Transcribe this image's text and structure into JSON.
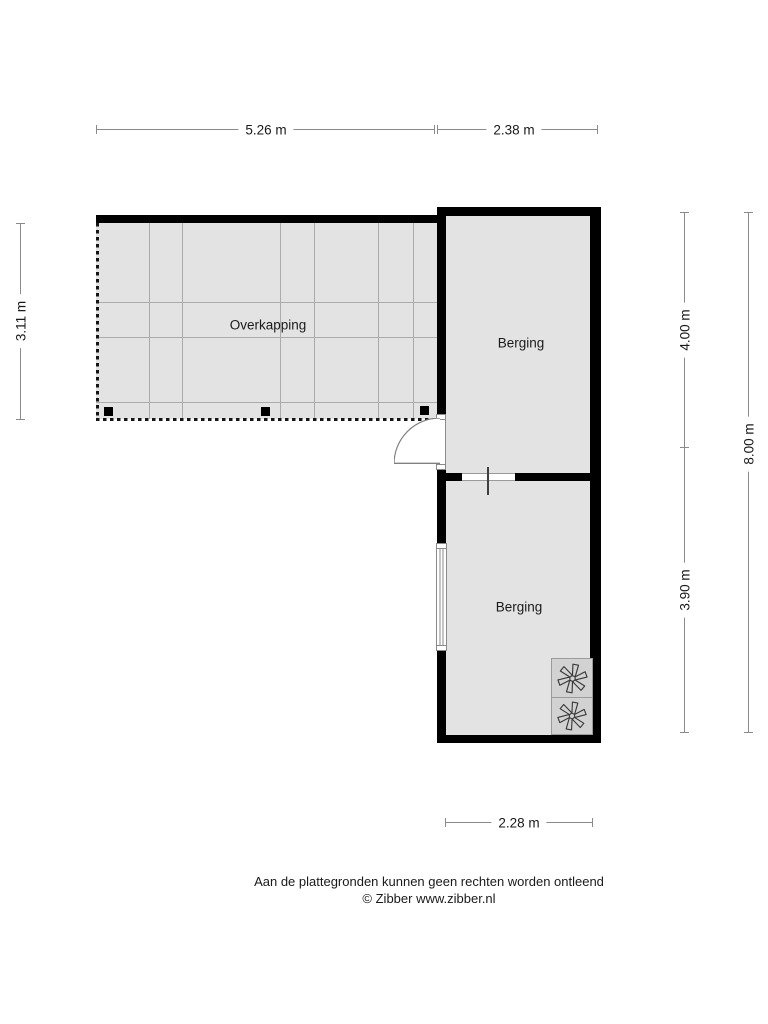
{
  "floorplan": {
    "rooms": [
      {
        "label": "Overkapping"
      },
      {
        "label": "Berging"
      },
      {
        "label": "Berging"
      }
    ],
    "dimensions": {
      "top_left": "5.26 m",
      "top_right": "2.38 m",
      "left": "3.11 m",
      "right_upper": "4.00 m",
      "right_lower": "3.90 m",
      "right_total": "8.00 m",
      "bottom": "2.28 m"
    },
    "colors": {
      "wall": "#000000",
      "floor": "#e3e3e3",
      "grid_line": "#ababab",
      "dimension_line": "#8a8a8a",
      "unit_panel": "#d2d2d2"
    },
    "icons": {
      "ventilation_unit": "fan-icon",
      "door": "door-swing-arc"
    }
  },
  "footer": {
    "disclaimer": "Aan de plattegronden kunnen geen rechten worden ontleend",
    "copyright": "© Zibber www.zibber.nl"
  }
}
